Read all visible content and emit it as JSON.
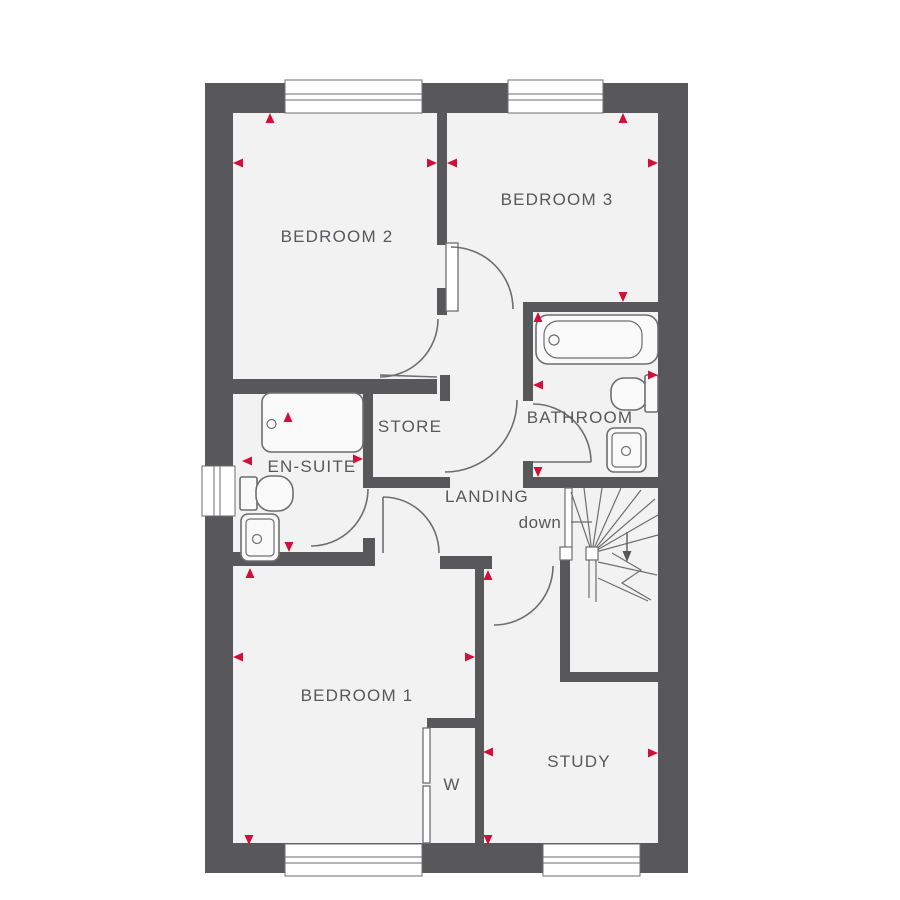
{
  "plan": {
    "type": "floor-plan",
    "rooms": {
      "bedroom2": "BEDROOM 2",
      "bedroom3": "BEDROOM 3",
      "bathroom": "BATHROOM",
      "store": "STORE",
      "ensuite": "EN-SUITE",
      "landing": "LANDING",
      "stairs_direction": "down",
      "bedroom1": "BEDROOM 1",
      "wardrobe": "W",
      "study": "STUDY"
    },
    "fixtures": [
      "bath",
      "shower-tray",
      "toilet",
      "sink",
      "staircase",
      "wardrobe-doors"
    ],
    "window_count": 5,
    "dimension_marker_count": 23
  },
  "colors": {
    "wall": "#58585a",
    "floor": "#f2f2f3",
    "line": "#6e6e70",
    "marker": "#d0103a",
    "text": "#58585a",
    "bg": "#ffffff"
  }
}
